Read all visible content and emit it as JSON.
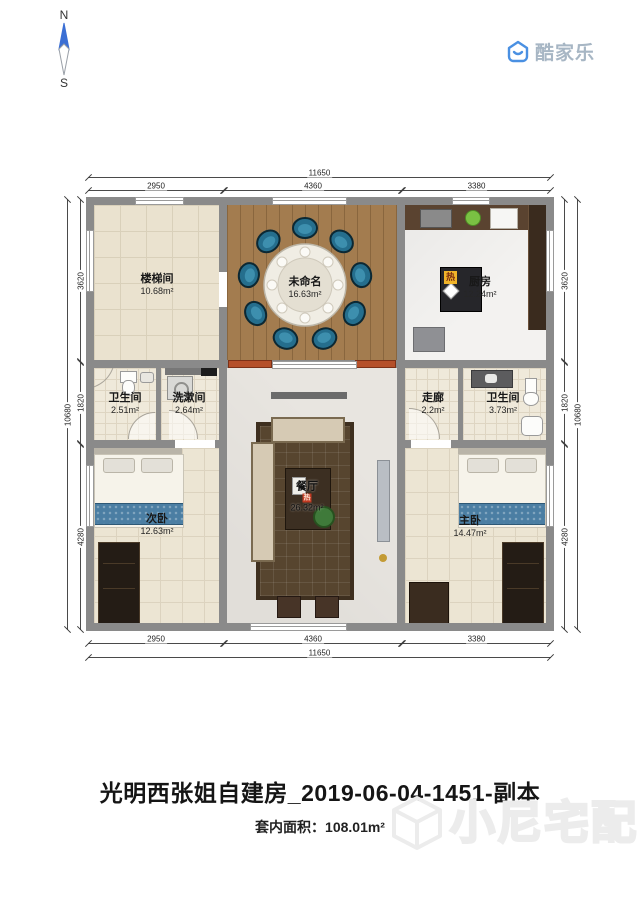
{
  "compass": {
    "north": "N",
    "south": "S"
  },
  "logo": {
    "brand": "酷家乐"
  },
  "dimensions": {
    "top": {
      "total": "11650",
      "segments": [
        "2950",
        "4360",
        "3380"
      ]
    },
    "bottom": {
      "total": "11650",
      "segments": [
        "2950",
        "4360",
        "3380"
      ]
    },
    "left": {
      "total": "10680",
      "segments": [
        "3620",
        "1820",
        "4280"
      ]
    },
    "right": {
      "total": "10680",
      "segments": [
        "3620",
        "1820",
        "4280"
      ]
    }
  },
  "rooms": {
    "staircase": {
      "name": "楼梯间",
      "area": "10.68m²"
    },
    "unnamed": {
      "name": "未命名",
      "area": "16.63m²"
    },
    "kitchen": {
      "name": "厨房",
      "area": "12.24m²",
      "hot_badge": "热"
    },
    "bathroom_left": {
      "name": "卫生间",
      "area": "2.51m²"
    },
    "washroom": {
      "name": "洗漱间",
      "area": "2.64m²"
    },
    "corridor": {
      "name": "走廊",
      "area": "2.2m²"
    },
    "bathroom_right": {
      "name": "卫生间",
      "area": "3.73m²"
    },
    "dining_living": {
      "name": "餐厅",
      "area": "26.32m²",
      "hot_badge": "热"
    },
    "second_bedroom": {
      "name": "次卧",
      "area": "12.63m²"
    },
    "master_bedroom": {
      "name": "主卧",
      "area": "14.47m²"
    }
  },
  "footer": {
    "title": "光明西张姐自建房_2019-06-04-1451-副本",
    "area_label": "套内面积：",
    "area_value": "108.01m²"
  },
  "watermark": {
    "text": "小尼宅配"
  },
  "colors": {
    "brand_blue": "#4a90e2",
    "wall_gray": "#8a8a8a",
    "hot_badge_yellow": "#f0b429",
    "hot_badge_red": "#c23a22",
    "chair_teal": "#256e8d",
    "door_orange": "#b5502a",
    "bed_blue": "#4b7ea3"
  }
}
